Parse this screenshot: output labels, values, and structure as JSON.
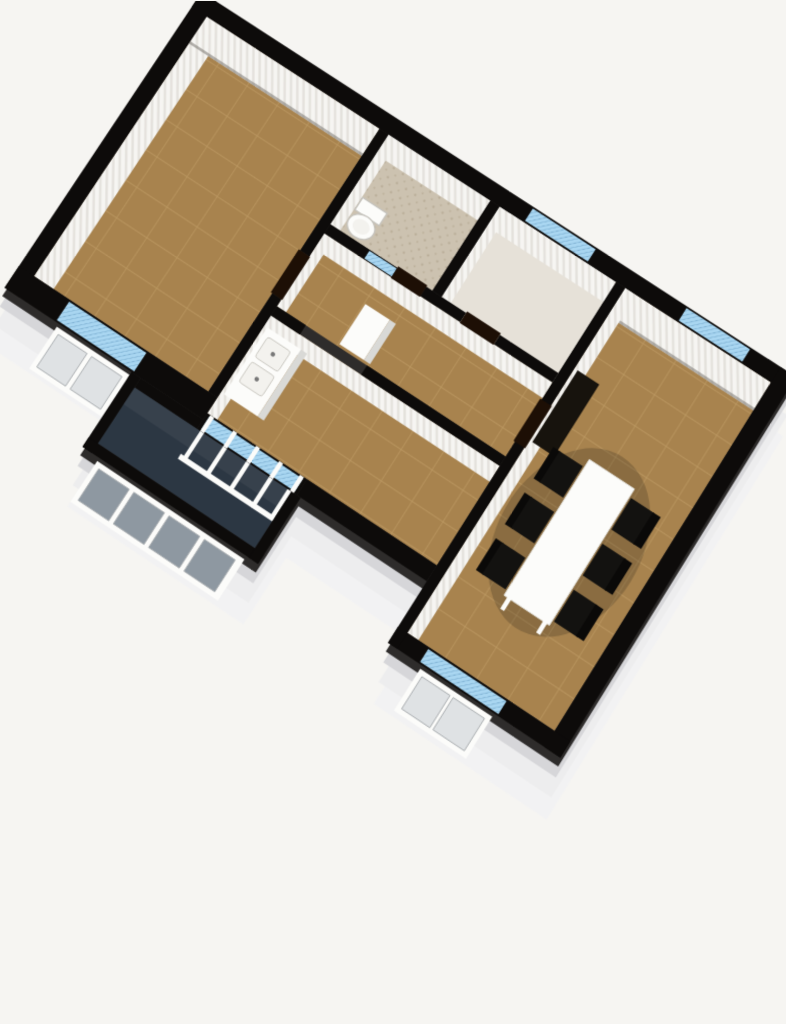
{
  "scene": {
    "type": "3d-floorplan-render",
    "view": "isometric, plan rotated ~33deg clockwise",
    "rooms": [
      {
        "id": "bedroom",
        "label": "Bedroom",
        "floor": "brown tile"
      },
      {
        "id": "bathroom",
        "label": "Bathroom",
        "floor": "beige ceramic"
      },
      {
        "id": "entry-hall",
        "label": "Entry Hall",
        "floor": "light"
      },
      {
        "id": "hallway",
        "label": "Hallway",
        "floor": "brown tile"
      },
      {
        "id": "kitchen",
        "label": "Kitchen",
        "floor": "brown tile"
      },
      {
        "id": "living-room",
        "label": "Living / Dining Room",
        "floor": "brown tile"
      },
      {
        "id": "balcony",
        "label": "Balcony",
        "floor": "dark"
      }
    ],
    "furniture": [
      {
        "id": "dining-table",
        "label": "Dining table"
      },
      {
        "id": "dining-chairs",
        "label": "Dining chairs",
        "count": 6
      },
      {
        "id": "kitchen-counter",
        "label": "Kitchen counter with double sink"
      },
      {
        "id": "refrigerator",
        "label": "Tall white cabinet / refrigerator"
      },
      {
        "id": "toilet",
        "label": "Toilet"
      },
      {
        "id": "wardrobe",
        "label": "Dark wardrobe"
      }
    ],
    "window_count": 6,
    "door_count": 4
  },
  "colors": {
    "background": "#f6f5f2",
    "wall_top": "#0d0b0a",
    "wall_bevel": "#2e2c2b",
    "ext_face_lighter": "#f2f2f3",
    "ext_face_light": "#ededee",
    "ext_face_mid": "#d6d6d9",
    "int_face": "#f6f5f2",
    "int_face_stripe": "#e3e0db",
    "baseboard": "#6e6a64",
    "floor_tile": "#a8834e",
    "floor_tile_line": "#bd9a63",
    "floor_bath": "#ccc2b0",
    "floor_bath_dot": "#b2a58f",
    "floor_entry": "#e6e1d8",
    "floor_balcony": "#2c3743",
    "window_sill": "#a9d6f1",
    "sill_hatch": "#6fa3c8",
    "glass_dark": "#37414c",
    "pane_light": "#dfe2e4",
    "pane_balcony": "#8e98a1",
    "white": "#fcfcfa",
    "white_side": "#d9d9d6",
    "basin": "#f3f2ee",
    "black_furniture": "#131210",
    "chair_back": "#0a0908",
    "wardrobe": "#17130d",
    "door": "#1d0f05"
  }
}
